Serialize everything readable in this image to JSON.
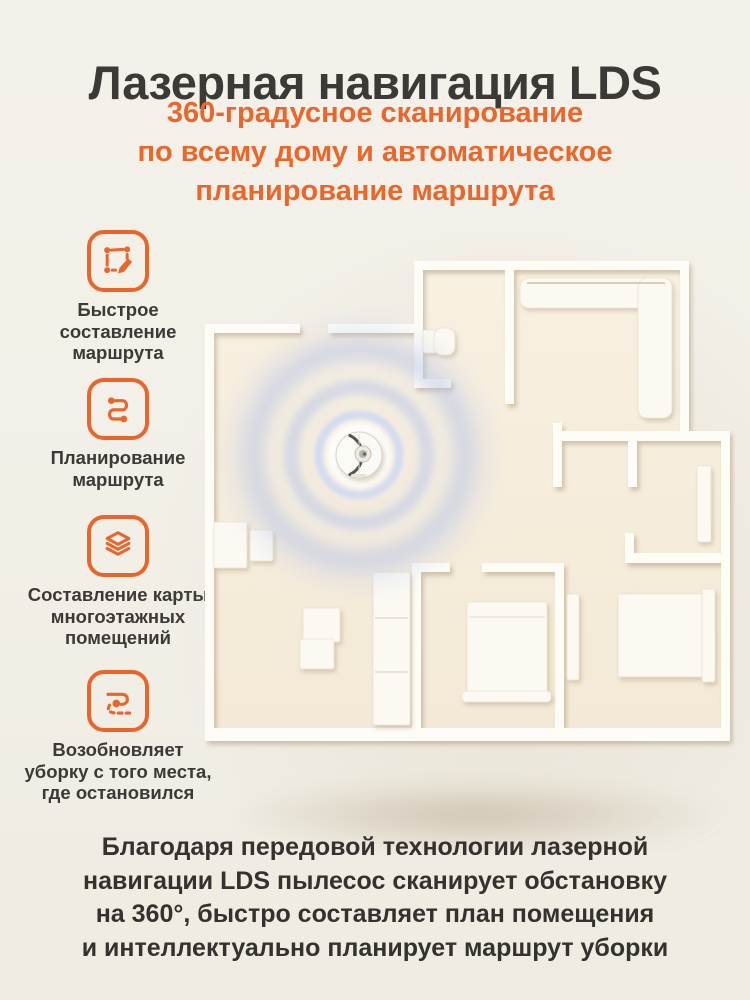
{
  "header": {
    "title": "Лазерная навигация LDS",
    "subtitle_lines": [
      "360-градусное сканирование",
      "по всему дому и автоматическое",
      "планирование маршрута"
    ]
  },
  "features": [
    {
      "icon": "route-draw-icon",
      "lines": [
        "Быстрое",
        "составление",
        "маршрута"
      ]
    },
    {
      "icon": "route-plan-icon",
      "lines": [
        "Планирование",
        "маршрута"
      ]
    },
    {
      "icon": "layers-icon",
      "lines": [
        "Составление карты",
        "многоэтажных",
        "помещений"
      ]
    },
    {
      "icon": "resume-clean-icon",
      "lines": [
        "Возобновляет",
        "уборку с того места,",
        "где остановился"
      ]
    }
  ],
  "floorplan": {
    "content": "top-down 3d apartment floor plan",
    "robot": "robot-vacuum scanning with LDS laser",
    "scan_rings": 3
  },
  "footer": {
    "paragraph_lines": [
      "Благодаря передовой технологии лазерной",
      "навигации LDS пылесос сканирует обстановку",
      "на 360°, быстро составляет план помещения",
      "и интеллектуально планирует маршрут уборки"
    ]
  },
  "colors": {
    "accent_orange": "#e8662b",
    "title_text": "#3b3a37",
    "body_text": "#33322f",
    "background": "#f2efe7",
    "floor": "#f6eddd",
    "walls": "#fdfcf7",
    "scan_ring_blue": "#b6c3e8"
  }
}
